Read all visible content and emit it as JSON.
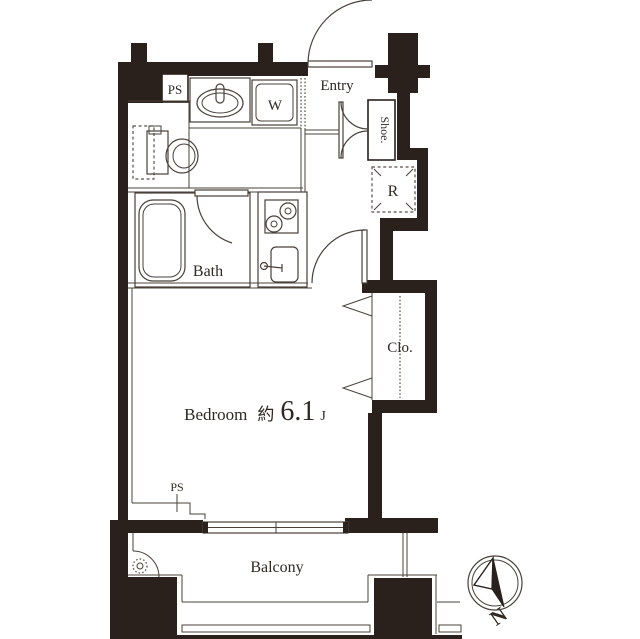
{
  "floorplan": {
    "rooms": {
      "entry": {
        "label": "Entry"
      },
      "bath": {
        "label": "Bath"
      },
      "bedroom": {
        "label": "Bedroom",
        "approx": "約",
        "area": "6.1",
        "unit": "J"
      },
      "balcony": {
        "label": "Balcony"
      }
    },
    "fixtures": {
      "shoe_cabinet": {
        "label": "Shoe."
      },
      "washing_machine": {
        "label": "W"
      },
      "refrigerator": {
        "label": "R"
      },
      "closet": {
        "label": "Clo."
      },
      "pipe_space_top": {
        "label": "PS"
      },
      "pipe_space_bottom": {
        "label": "PS"
      }
    },
    "compass": {
      "north": "N"
    },
    "colors": {
      "wall": "#2a211c",
      "line": "#49403a",
      "text": "#2f2823",
      "background": "#ffffff"
    }
  }
}
